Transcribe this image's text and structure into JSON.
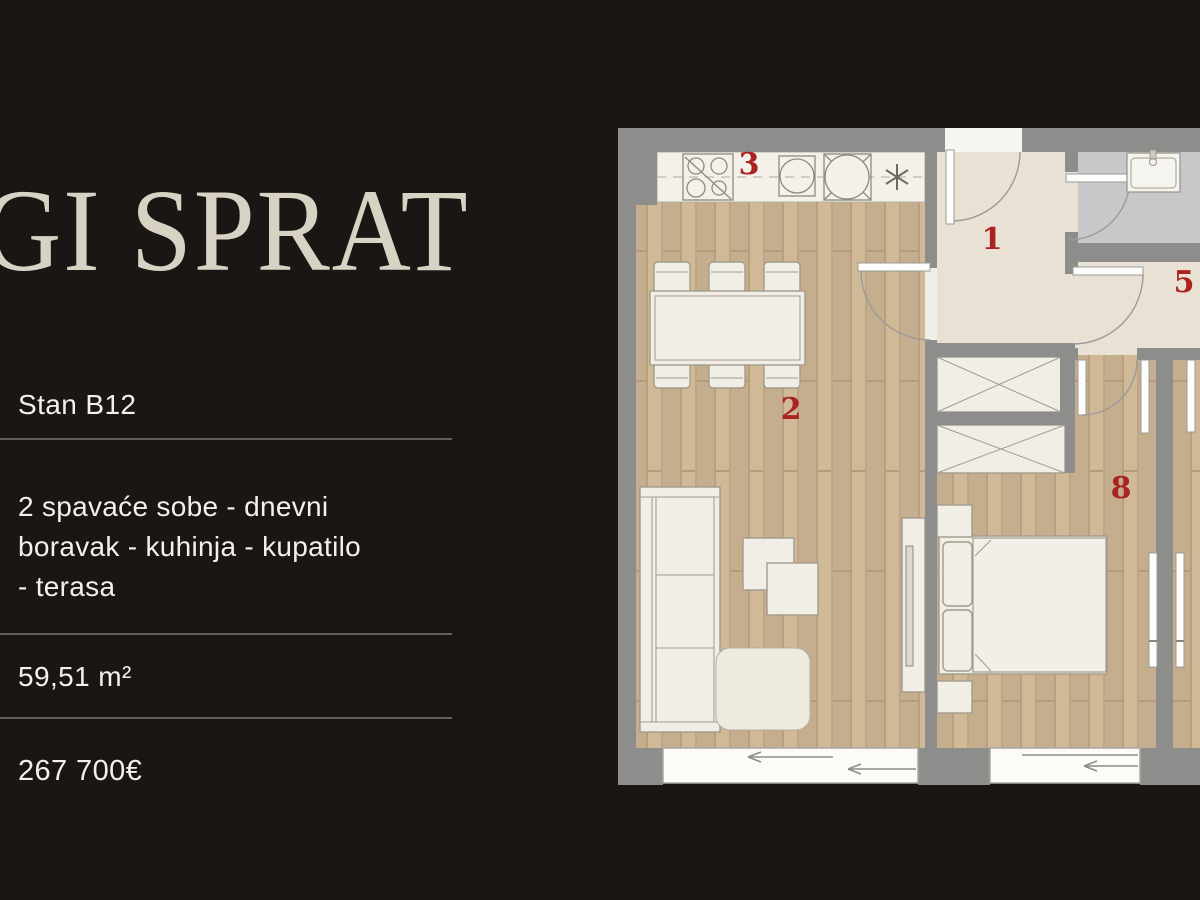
{
  "theme": {
    "bg": "#1a1613",
    "title": "#d8d2c5",
    "text": "#f3f1ed",
    "divider": "#61605b",
    "red": "#ab2320",
    "wall": "#8d8d8b",
    "wood": "#c9b293",
    "tile": "#e8e1d4",
    "bath": "#c6c8ca"
  },
  "panel": {
    "title": "GI SPRAT",
    "unit_name": "Stan B12",
    "description_lines": [
      "2 spavaće sobe - dnevni",
      "boravak - kuhinja - kupatilo",
      "- terasa"
    ],
    "area": "59,51 m²",
    "price": "267 700€"
  },
  "floor_plan": {
    "rooms": {
      "hallway": "1",
      "living_room": "2",
      "kitchen": "3",
      "room_5": "5",
      "bedroom": "8"
    }
  }
}
